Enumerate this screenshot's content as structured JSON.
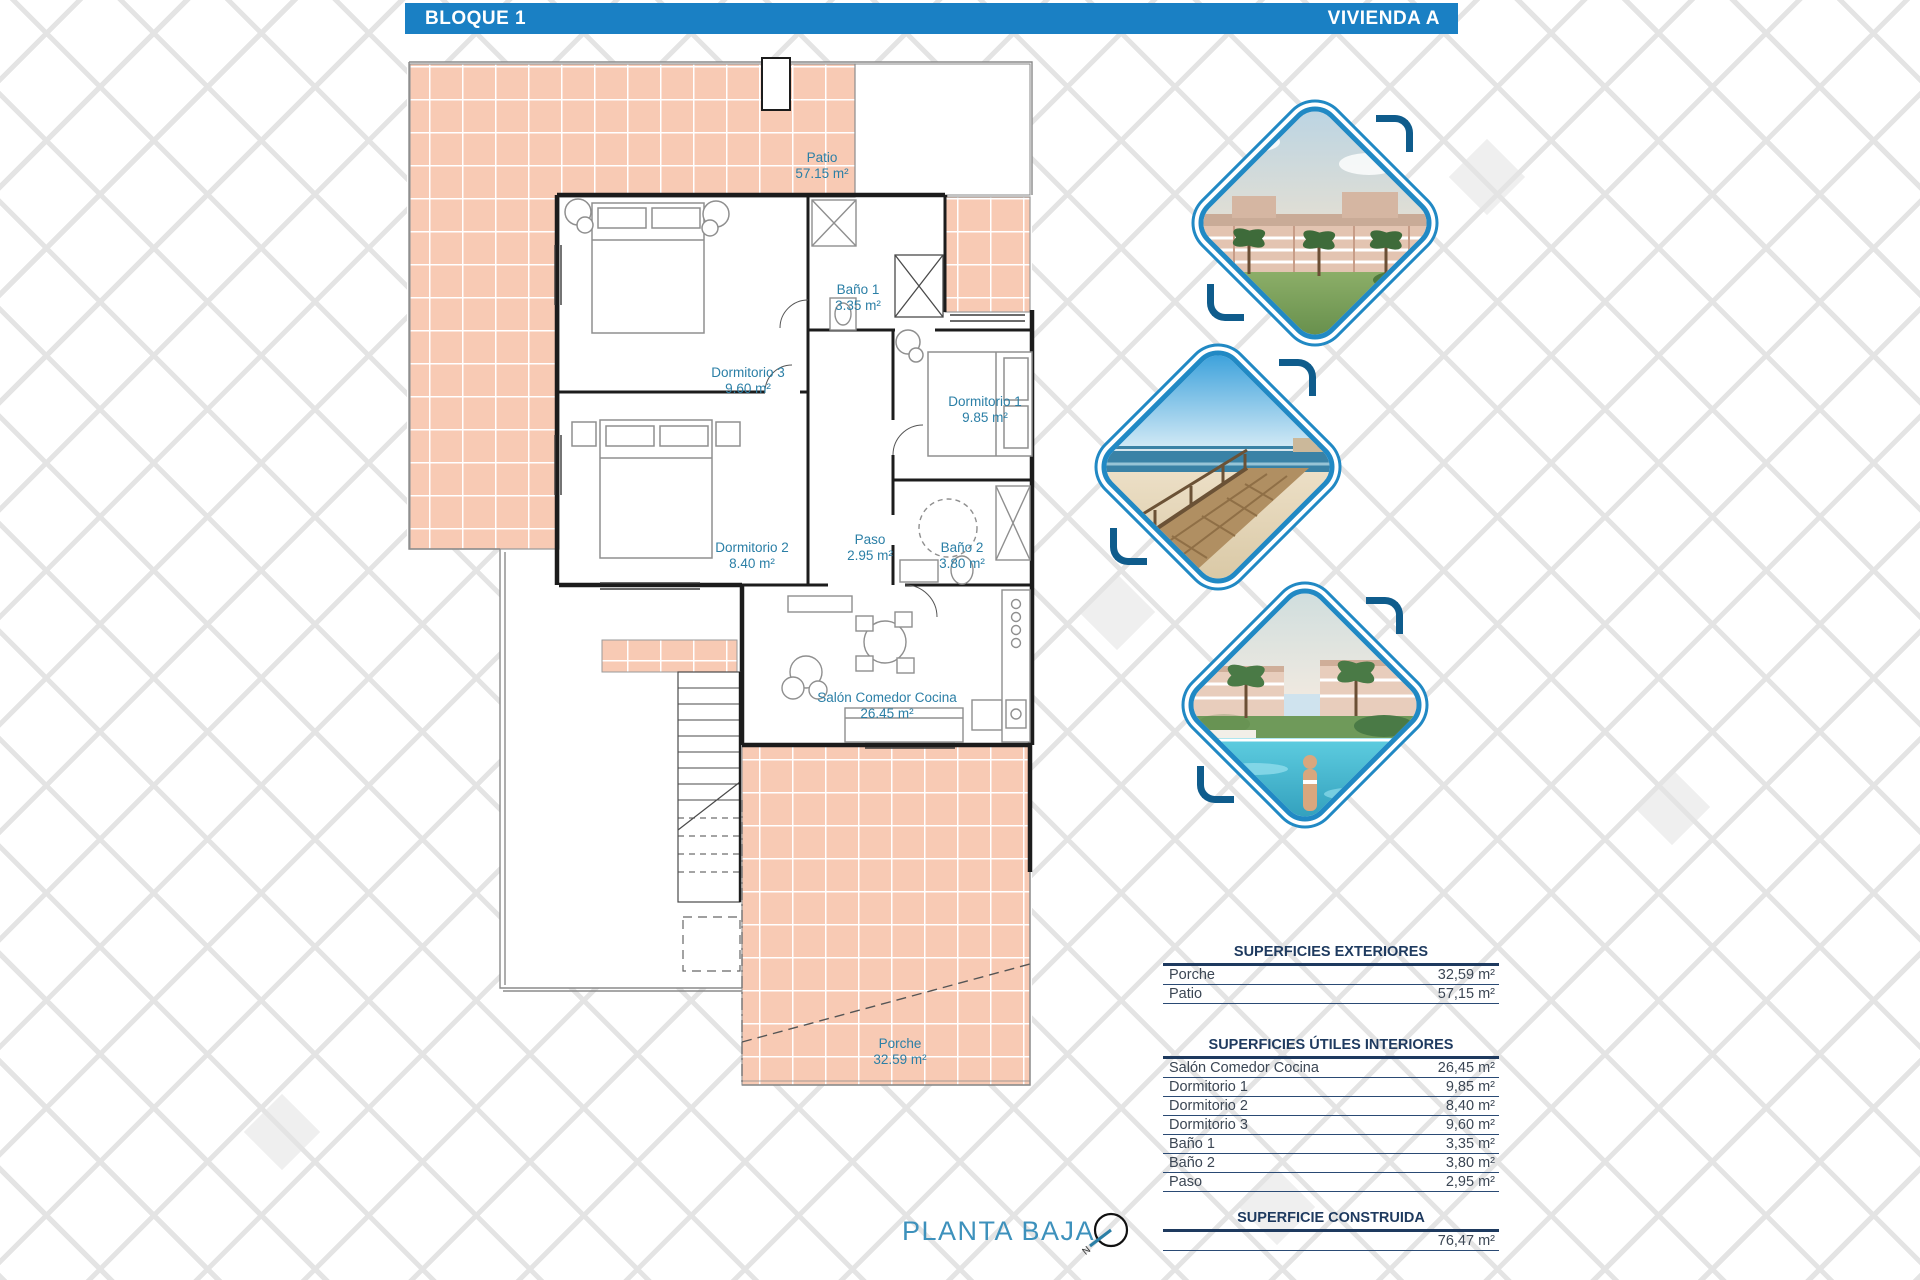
{
  "header": {
    "left": "BLOQUE 1",
    "right": "VIVIENDA A"
  },
  "plan": {
    "floor_title": "PLANTA BAJA",
    "compass": "N",
    "rooms": {
      "patio": {
        "label": "Patio",
        "area": "57.15 m²"
      },
      "bano1": {
        "label": "Baño 1",
        "area": "3.35 m²"
      },
      "dormitorio3": {
        "label": "Dormitorio 3",
        "area": "9.60 m²"
      },
      "dormitorio1": {
        "label": "Dormitorio 1",
        "area": "9.85 m²"
      },
      "dormitorio2": {
        "label": "Dormitorio 2",
        "area": "8.40 m²"
      },
      "paso": {
        "label": "Paso",
        "area": "2.95 m²"
      },
      "bano2": {
        "label": "Baño 2",
        "area": "3.80 m²"
      },
      "salon": {
        "label": "Salón Comedor Cocina",
        "area": "26.45 m²"
      },
      "porche": {
        "label": "Porche",
        "area": "32.59 m²"
      }
    }
  },
  "photos": [
    {
      "name": "apartments-render"
    },
    {
      "name": "beach-boardwalk"
    },
    {
      "name": "pool-garden"
    }
  ],
  "tables": {
    "exteriores": {
      "title": "SUPERFICIES EXTERIORES",
      "rows": [
        [
          "Porche",
          "32,59 m²"
        ],
        [
          "Patio",
          "57,15 m²"
        ]
      ]
    },
    "interiores": {
      "title": "SUPERFICIES ÚTILES INTERIORES",
      "rows": [
        [
          "Salón Comedor Cocina",
          "26,45 m²"
        ],
        [
          "Dormitorio 1",
          "9,85 m²"
        ],
        [
          "Dormitorio 2",
          "8,40 m²"
        ],
        [
          "Dormitorio 3",
          "9,60 m²"
        ],
        [
          "Baño 1",
          "3,35 m²"
        ],
        [
          "Baño 2",
          "3,80 m²"
        ],
        [
          "Paso",
          "2,95 m²"
        ]
      ]
    },
    "construida": {
      "title": "SUPERFICIE CONSTRUIDA",
      "value": "76,47 m²"
    }
  },
  "colors": {
    "accent_blue": "#1a80c4",
    "tile_salmon": "#f8cab4",
    "room_label_teal": "#2b7fa6",
    "table_navy": "#1e3a5f",
    "plan_title_blue": "#3d91bc",
    "diamond_border": "#2189c4"
  }
}
